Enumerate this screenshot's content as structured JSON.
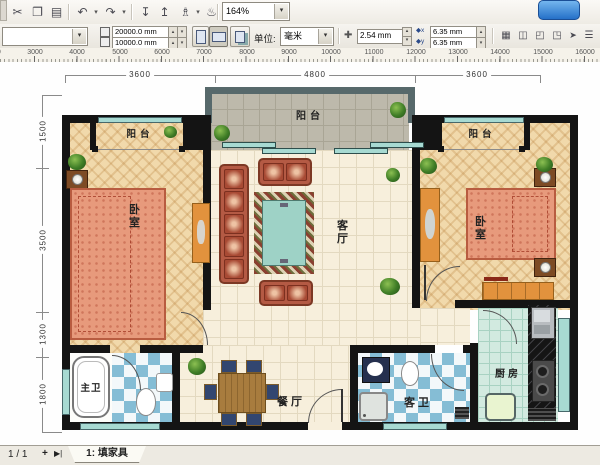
{
  "toolbar": {
    "zoom_level": "164%",
    "caret_glyph": "▾",
    "spin_up": "▴",
    "spin_down": "▾",
    "icons": [
      {
        "name": "cut",
        "glyph": "✂"
      },
      {
        "name": "copy",
        "glyph": "❐"
      },
      {
        "name": "paste",
        "glyph": "▤"
      },
      {
        "name": "undo",
        "glyph": "↶"
      },
      {
        "name": "redo",
        "glyph": "↷"
      },
      {
        "name": "import",
        "glyph": "↧"
      },
      {
        "name": "export",
        "glyph": "↥"
      },
      {
        "name": "app-launcher",
        "glyph": "♗"
      },
      {
        "name": "corel-online",
        "glyph": "♨"
      }
    ]
  },
  "property_bar": {
    "page_width": "20000.0 mm",
    "page_height": "10000.0 mm",
    "units_label": "单位:",
    "units_value": "毫米",
    "nudge_icon": "✚",
    "nudge_offset": "2.54 mm",
    "dup_x_prefix": "◆x",
    "dup_x_value": "6.35 mm",
    "dup_y_prefix": "◆y",
    "dup_y_value": "6.35 mm",
    "snap_icons": [
      {
        "name": "snap-to-grid",
        "glyph": "▦"
      },
      {
        "name": "snap-to-guidelines",
        "glyph": "◫"
      },
      {
        "name": "snap-to-objects",
        "glyph": "◰"
      },
      {
        "name": "dynamic-guides",
        "glyph": "◳"
      },
      {
        "name": "treat-as-filled",
        "glyph": "➤"
      },
      {
        "name": "property-bar-toggle",
        "glyph": "☰"
      }
    ]
  },
  "ruler": {
    "labels": [
      "2000",
      "3000",
      "4000",
      "5000",
      "6000",
      "7000",
      "8000",
      "9000",
      "10000",
      "11000",
      "12000",
      "13000",
      "14000",
      "15000",
      "16000"
    ]
  },
  "floor_plan": {
    "dim_top": [
      "3600",
      "4800",
      "3600"
    ],
    "dim_left": [
      "1500",
      "3500",
      "1300",
      "1800"
    ],
    "rooms": {
      "balcony_left": "阳台",
      "balcony_center": "阳台",
      "balcony_right": "阳台",
      "bedroom_left": "卧室",
      "bedroom_right": "卧室",
      "living": "客厅",
      "dining": "餐厅",
      "master_bath": "主卫",
      "guest_bath": "客卫",
      "kitchen": "厨房"
    }
  },
  "status_bar": {
    "page_indicator": "1 / 1",
    "add_page_label": "+",
    "last_page_label": "▶|",
    "tab_label": "1: 填家具"
  }
}
